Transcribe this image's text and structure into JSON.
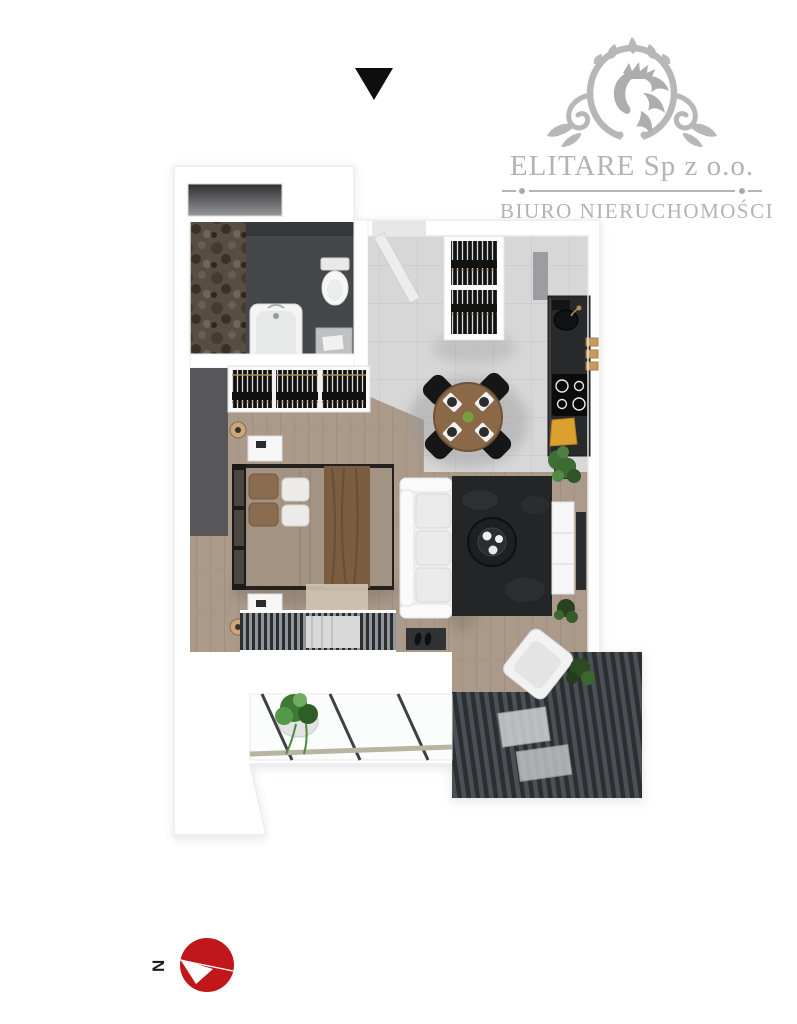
{
  "page": {
    "background_color": "#ffffff"
  },
  "marker": {
    "symbol": "downward-triangle",
    "color": "#0e0e0e"
  },
  "logo": {
    "company_name": "ELITARE Sp z o.o.",
    "tagline": "BIURO NIERUCHOMOŚCI",
    "emblem": "lion-crest-ornament",
    "text_color": "#b3b3b3",
    "emblem_color": "#b7b7b7"
  },
  "floor_plan": {
    "type": "3d-top-down-apartment-render",
    "rooms": [
      {
        "name": "Bathroom",
        "features": [
          "stone accent wall",
          "storage niche",
          "bathtub",
          "toilet",
          "washing machine"
        ]
      },
      {
        "name": "Entry hall",
        "features": [
          "entrance door",
          "open wardrobe with hangers",
          "light tiled floor"
        ]
      },
      {
        "name": "Kitchen",
        "features": [
          "dark counter",
          "sink",
          "induction hob 4 rings",
          "wooden cutting board",
          "wall shelves",
          "potted plant"
        ]
      },
      {
        "name": "Dining area",
        "features": [
          "round wooden table",
          "4 black chairs",
          "4 white place settings",
          "small green plant"
        ]
      },
      {
        "name": "Bedroom",
        "features": [
          "double bed",
          "brown throw",
          "brown and white pillows",
          "open wardrobe with hangers",
          "2 white nightstands",
          "2 beige lamps",
          "beige rug",
          "dark accent wall",
          "striped window band"
        ]
      },
      {
        "name": "Living area",
        "features": [
          "white sofa",
          "dark rug",
          "round black coffee table with cups",
          "white tv sideboard",
          "wall-mounted tv",
          "potted plants",
          "doormat with shoes"
        ]
      },
      {
        "name": "Balcony",
        "features": [
          "glass balustrade",
          "white tiled parapet",
          "hanging potted plant",
          "dark striped decking",
          "white lounge chair",
          "small dark plant"
        ]
      }
    ],
    "palette": {
      "walls": "#ffffff",
      "tile_floor": "#d7d7d7",
      "wood_floor": "#ab9a8a",
      "bathroom_floor": "#46474a",
      "kitchen_counter": "#27292b",
      "dark_rug": "#232526",
      "deck": "#3d4145",
      "bed_throw": "#7b5d41",
      "table_wood": "#8a6848",
      "plant_green": "#3f7a33"
    }
  },
  "compass": {
    "label": "N",
    "disc_color": "#c1171b",
    "needle_color": "#ffffff",
    "pointing": "left"
  }
}
